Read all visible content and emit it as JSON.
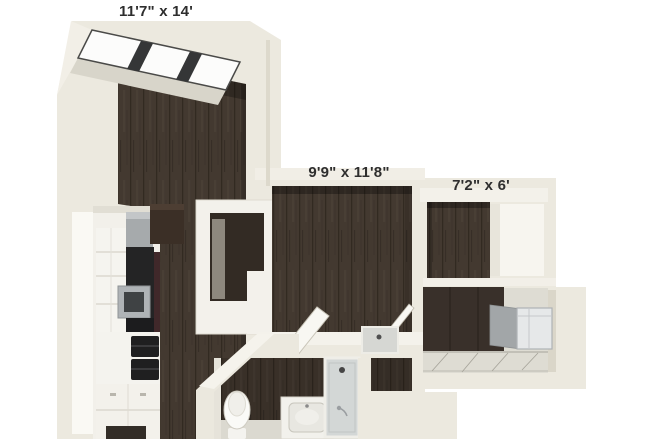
{
  "floorplan": {
    "background": "#ffffff",
    "rooms": [
      {
        "name": "living-dining",
        "label": "11'7\" x 14'"
      },
      {
        "name": "bedroom",
        "label": "9'9\" x 11'8\""
      },
      {
        "name": "den",
        "label": "7'2\" x 6'"
      }
    ],
    "palette": {
      "wall": "#ECE9DF",
      "wall_bright": "#F5F3EC",
      "wall_shadow": "#D8D4C7",
      "wood_floor": "#433930",
      "tile_floor": "#DEDCD3",
      "appliance_dark": "#242425",
      "appliance_steel": "#A6AAAC",
      "fixture_white": "#FAFAF7",
      "label_text": "#2E2E2E"
    }
  }
}
